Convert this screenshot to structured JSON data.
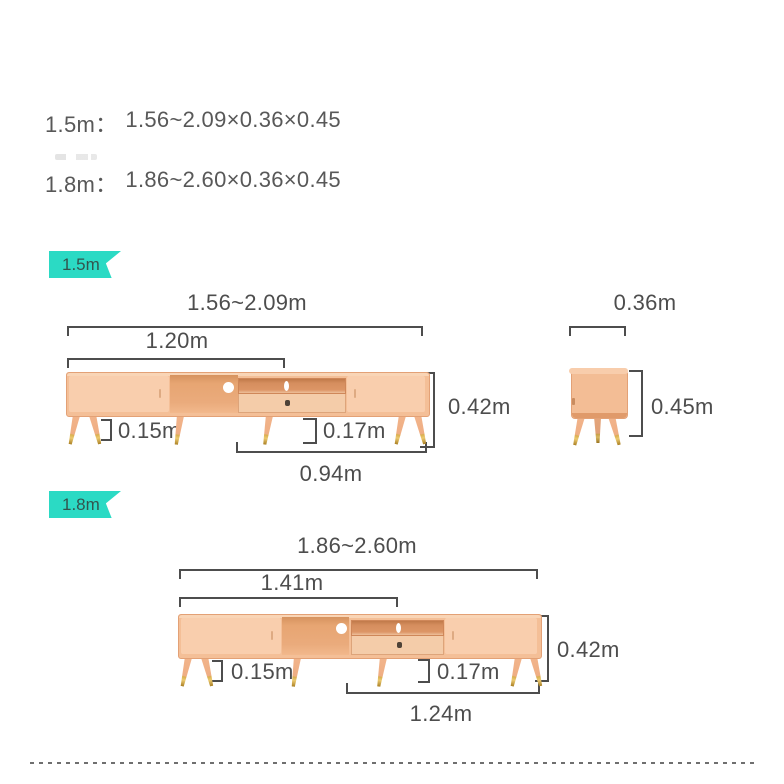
{
  "specs": {
    "lines": [
      {
        "label": "1.5m：",
        "value": "1.56~2.09×0.36×0.45"
      },
      {
        "label": "1.8m：",
        "value": "1.86~2.60×0.36×0.45"
      }
    ]
  },
  "v15": {
    "badge": "1.5m",
    "front": {
      "total": "1.56~2.09m",
      "fixed": "1.20m",
      "leg_height": "0.15m",
      "clearance": "0.17m",
      "bottom_span": "0.94m",
      "height": "0.42m"
    },
    "side": {
      "depth": "0.36m",
      "height": "0.45m"
    }
  },
  "v18": {
    "badge": "1.8m",
    "front": {
      "total": "1.86~2.60m",
      "fixed": "1.41m",
      "leg_height": "0.15m",
      "clearance": "0.17m",
      "bottom_span": "1.24m",
      "height": "0.42m"
    }
  },
  "colors": {
    "badge_bg": "#2bdac4",
    "badge_text": "#33544e",
    "dim_line": "#4d4d4d",
    "spec_text": "#585858",
    "wood_body": "#f4bf97",
    "wood_door": "#f9cead",
    "wood_cavity": "#e7a572",
    "wood_shelf": "#d68e5e",
    "wood_drawer": "#f4cca9",
    "leg_brass_tip": "#dab04f"
  }
}
